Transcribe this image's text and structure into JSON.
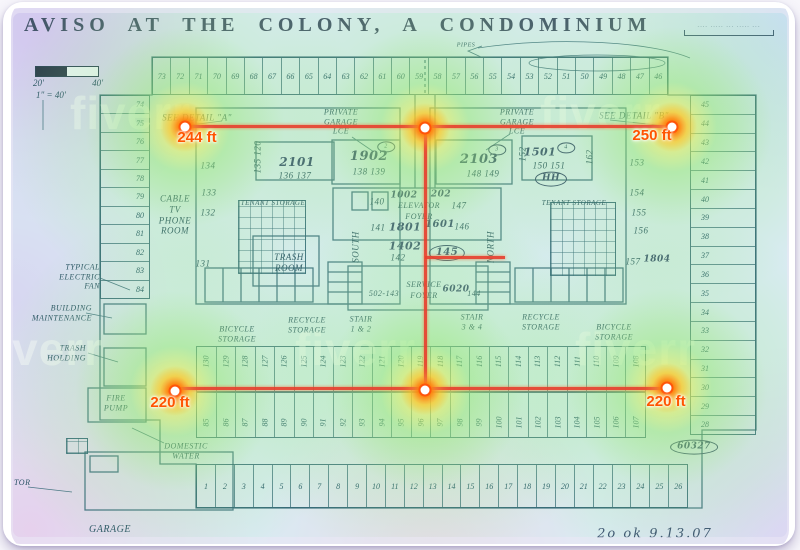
{
  "title": "AVISO  AT  THE  COLONY,  A  CONDOMINIUM",
  "watermark": "fiverr",
  "note_topright": "-··- ···-· -·· ··-·· -·-",
  "date_note": "2o  ok   9.13.07",
  "scale": {
    "left": "20'",
    "right": "40'",
    "ratio": "1\" = 40'"
  },
  "measurements": {
    "a": "244 ft",
    "b": "250 ft",
    "c": "220 ft",
    "d": "220 ft"
  },
  "parking": {
    "top_row": [
      "73",
      "72",
      "71",
      "70",
      "69",
      "68",
      "67",
      "66",
      "65",
      "64",
      "63",
      "62",
      "61",
      "60",
      "59",
      "58",
      "57",
      "56",
      "55",
      "54",
      "53",
      "52",
      "51",
      "50",
      "49",
      "48",
      "47",
      "46"
    ],
    "left_col": [
      "74",
      "75",
      "76",
      "77",
      "78",
      "79",
      "80",
      "81",
      "82",
      "83",
      "84"
    ],
    "right_col": [
      "45",
      "44",
      "43",
      "42",
      "41",
      "40",
      "39",
      "38",
      "37",
      "36",
      "35",
      "34",
      "33",
      "32",
      "31",
      "30",
      "29",
      "28"
    ],
    "mid_upper": [
      "130",
      "129",
      "128",
      "127",
      "126",
      "125",
      "124",
      "123",
      "122",
      "121",
      "120",
      "119",
      "118",
      "117",
      "116",
      "115",
      "114",
      "113",
      "112",
      "111",
      "110",
      "109",
      "108"
    ],
    "mid_lower": [
      "85",
      "86",
      "87",
      "88",
      "89",
      "90",
      "91",
      "92",
      "93",
      "94",
      "95",
      "96",
      "97",
      "98",
      "99",
      "100",
      "101",
      "102",
      "103",
      "104",
      "105",
      "106",
      "107"
    ],
    "bottom_row": [
      "1",
      "2",
      "3",
      "4",
      "5",
      "6",
      "7",
      "8",
      "9",
      "10",
      "11",
      "12",
      "13",
      "14",
      "15",
      "16",
      "17",
      "18",
      "19",
      "20",
      "21",
      "22",
      "23",
      "24",
      "25",
      "26"
    ]
  },
  "annotations": [
    {
      "n": "see-detail-a-label",
      "t": "SEE  DETAIL  \"A\"",
      "x": 197,
      "y": 118,
      "s": 9
    },
    {
      "n": "see-detail-b-label",
      "t": "SEE  DETAIL  \"B\"",
      "x": 634,
      "y": 116,
      "s": 9
    },
    {
      "n": "private-garage-left-label",
      "t": "PRIVATE\nGARAGE\nLCE",
      "x": 341,
      "y": 122,
      "s": 8
    },
    {
      "n": "private-garage-right-label",
      "t": "PRIVATE\nGARAGE\nLCE",
      "x": 517,
      "y": 122,
      "s": 8
    },
    {
      "n": "unit-2101",
      "t": "2101",
      "x": 297,
      "y": 162,
      "s": 12,
      "c": "hand"
    },
    {
      "t": "136   137",
      "x": 295,
      "y": 176,
      "s": 9
    },
    {
      "n": "unit-1902",
      "t": "1902",
      "x": 369,
      "y": 157,
      "s": 13,
      "c": "hand"
    },
    {
      "t": "138  139",
      "x": 369,
      "y": 172,
      "s": 9
    },
    {
      "n": "unit-2103",
      "t": "2103",
      "x": 479,
      "y": 160,
      "s": 13,
      "c": "hand"
    },
    {
      "t": "148  149",
      "x": 483,
      "y": 174,
      "s": 9
    },
    {
      "n": "unit-1501",
      "t": "1501",
      "x": 540,
      "y": 152,
      "s": 11,
      "c": "hand"
    },
    {
      "t": "150   151",
      "x": 549,
      "y": 166,
      "s": 9
    },
    {
      "t": "HH",
      "x": 551,
      "y": 179,
      "s": 9,
      "c": "hand",
      "oval": true
    },
    {
      "t": "2",
      "x": 386,
      "y": 147,
      "s": 6,
      "oval": true
    },
    {
      "t": "3",
      "x": 497,
      "y": 150,
      "s": 6,
      "oval": true
    },
    {
      "t": "4",
      "x": 566,
      "y": 148,
      "s": 6,
      "oval": true
    },
    {
      "t": "134",
      "x": 208,
      "y": 166,
      "s": 9
    },
    {
      "t": "133",
      "x": 209,
      "y": 193,
      "s": 9
    },
    {
      "t": "132",
      "x": 208,
      "y": 213,
      "s": 9
    },
    {
      "t": "131",
      "x": 203,
      "y": 264,
      "s": 9
    },
    {
      "t": "135  120",
      "x": 258,
      "y": 157,
      "s": 9,
      "r": 1
    },
    {
      "t": "152",
      "x": 523,
      "y": 154,
      "s": 9,
      "r": 1
    },
    {
      "t": "162",
      "x": 590,
      "y": 157,
      "s": 9,
      "r": 1
    },
    {
      "n": "cable-tv-phone-room-label",
      "t": "CABLE\nTV\nPHONE\nROOM",
      "x": 175,
      "y": 215,
      "s": 9
    },
    {
      "n": "tenant-storage-left-label",
      "t": "TENANT STORAGE",
      "x": 273,
      "y": 203,
      "s": 7
    },
    {
      "n": "tenant-storage-right-label",
      "t": "TENANT STORAGE",
      "x": 574,
      "y": 203,
      "s": 7
    },
    {
      "n": "trash-room-label",
      "t": "TRASH\nROOM",
      "x": 289,
      "y": 263,
      "s": 9
    },
    {
      "t": "140",
      "x": 377,
      "y": 202,
      "s": 9
    },
    {
      "t": "1002",
      "x": 404,
      "y": 196,
      "s": 9,
      "c": "hand"
    },
    {
      "t": "202",
      "x": 441,
      "y": 195,
      "s": 9,
      "c": "hand"
    },
    {
      "n": "elevator-foyer-label",
      "t": "ELEVATOR",
      "x": 419,
      "y": 206,
      "s": 8
    },
    {
      "t": "147",
      "x": 459,
      "y": 206,
      "s": 9
    },
    {
      "t": "FOYER",
      "x": 419,
      "y": 217,
      "s": 8
    },
    {
      "t": "141",
      "x": 378,
      "y": 228,
      "s": 9
    },
    {
      "t": "1801",
      "x": 405,
      "y": 227,
      "s": 11,
      "c": "hand"
    },
    {
      "t": "1601",
      "x": 440,
      "y": 225,
      "s": 10,
      "c": "hand"
    },
    {
      "t": "146",
      "x": 462,
      "y": 227,
      "s": 9
    },
    {
      "t": "1402",
      "x": 405,
      "y": 246,
      "s": 11,
      "c": "hand"
    },
    {
      "t": "142",
      "x": 398,
      "y": 258,
      "s": 9
    },
    {
      "t": "145",
      "x": 447,
      "y": 253,
      "s": 10,
      "c": "hand",
      "oval": true
    },
    {
      "t": "SOUTH",
      "x": 356,
      "y": 247,
      "s": 9,
      "r": 1
    },
    {
      "t": "NORTH",
      "x": 491,
      "y": 247,
      "s": 9,
      "r": 1
    },
    {
      "n": "service-foyer-label",
      "t": "SERVICE",
      "x": 424,
      "y": 285,
      "s": 8
    },
    {
      "t": "FOYER",
      "x": 424,
      "y": 296,
      "s": 8
    },
    {
      "t": "502-143",
      "x": 384,
      "y": 294,
      "s": 8
    },
    {
      "t": "6020",
      "x": 456,
      "y": 290,
      "s": 9,
      "c": "hand"
    },
    {
      "t": "144",
      "x": 474,
      "y": 294,
      "s": 8
    },
    {
      "t": "153",
      "x": 637,
      "y": 163,
      "s": 9
    },
    {
      "t": "154",
      "x": 637,
      "y": 193,
      "s": 9
    },
    {
      "t": "155",
      "x": 639,
      "y": 213,
      "s": 9
    },
    {
      "t": "156",
      "x": 641,
      "y": 231,
      "s": 9
    },
    {
      "t": "157",
      "x": 633,
      "y": 262,
      "s": 9
    },
    {
      "t": "1804",
      "x": 657,
      "y": 260,
      "s": 9,
      "c": "hand"
    },
    {
      "n": "recycle-storage-left-label",
      "t": "RECYCLE\nSTORAGE",
      "x": 307,
      "y": 325,
      "s": 8
    },
    {
      "n": "stair-12-label",
      "t": "STAIR\n1 & 2",
      "x": 361,
      "y": 324,
      "s": 8
    },
    {
      "n": "stair-34-label",
      "t": "STAIR\n3 & 4",
      "x": 472,
      "y": 322,
      "s": 8
    },
    {
      "n": "recycle-storage-right-label",
      "t": "RECYCLE\nSTORAGE",
      "x": 541,
      "y": 322,
      "s": 8
    },
    {
      "n": "bicycle-storage-left-label",
      "t": "BICYCLE\nSTORAGE",
      "x": 237,
      "y": 334,
      "s": 8
    },
    {
      "n": "bicycle-storage-right-label",
      "t": "BICYCLE\nSTORAGE",
      "x": 614,
      "y": 332,
      "s": 8
    },
    {
      "n": "typical-electric-fan-label",
      "t": "TYPICAL\nELECTRIC\nFAN",
      "x": 100,
      "y": 277,
      "s": 8,
      "a": "right"
    },
    {
      "n": "building-maintenance-label",
      "t": "BUILDING\nMAINTENANCE",
      "x": 92,
      "y": 313,
      "s": 8,
      "a": "right"
    },
    {
      "n": "trash-holding-label",
      "t": "TRASH\nHOLDING",
      "x": 86,
      "y": 353,
      "s": 8,
      "a": "right"
    },
    {
      "n": "fire-pump-label",
      "t": "FIRE\nPUMP",
      "x": 116,
      "y": 403,
      "s": 8
    },
    {
      "n": "domestic-water-label",
      "t": "DOMESTIC\nWATER",
      "x": 186,
      "y": 451,
      "s": 8
    },
    {
      "n": "garage-label",
      "t": "GARAGE",
      "x": 110,
      "y": 530,
      "s": 10
    },
    {
      "t": "TOR",
      "x": 14,
      "y": 483,
      "s": 8,
      "a": "left"
    },
    {
      "t": "PIPES",
      "x": 466,
      "y": 46,
      "s": 6
    },
    {
      "t": "60327",
      "x": 694,
      "y": 447,
      "s": 9,
      "c": "hand",
      "oval": true
    }
  ]
}
